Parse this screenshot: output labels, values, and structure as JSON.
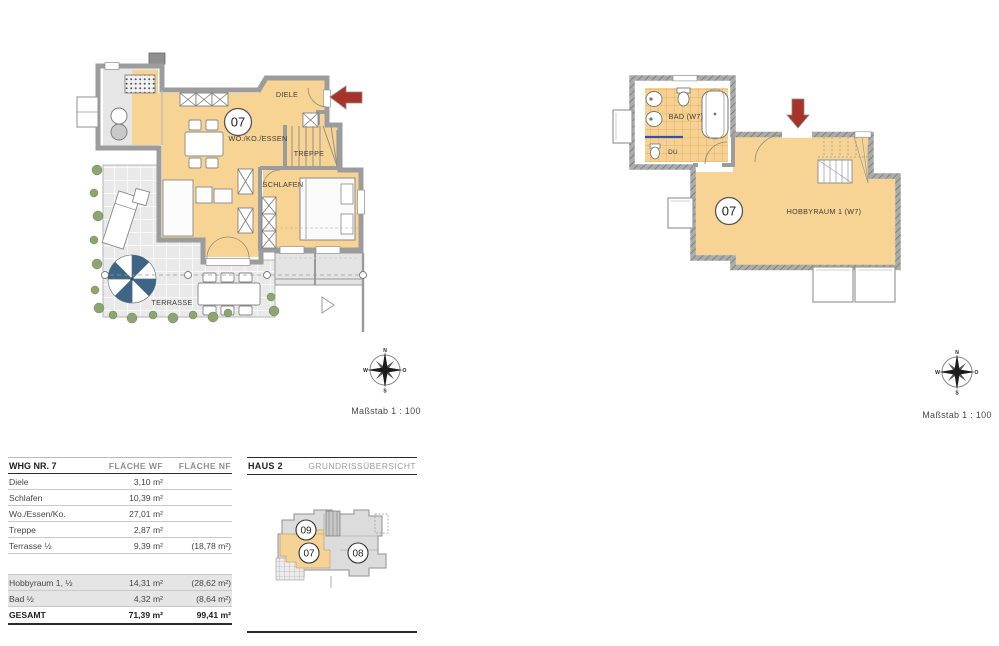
{
  "sheet": {
    "scale_left": "Maßstab 1 : 100",
    "scale_right": "Maßstab 1 : 100"
  },
  "compass": {
    "n": "N",
    "e": "O",
    "s": "S",
    "w": "W"
  },
  "plan_ground": {
    "unit": "07",
    "labels": {
      "diele": "DIELE",
      "wohnen": "WO./KO./ESSEN",
      "treppe": "TREPPE",
      "schlafen": "SCHLAFEN",
      "terrasse": "TERRASSE"
    }
  },
  "plan_basement": {
    "unit": "07",
    "labels": {
      "bad": "BAD (W7)",
      "dusche": "DU",
      "hobbyraum": "HOBBYRAUM 1 (W7)"
    }
  },
  "area_table": {
    "columns": {
      "c1": "WHG NR. 7",
      "c2": "FLÄCHE WF",
      "c3": "FLÄCHE NF"
    },
    "rows": [
      {
        "label": "Diele",
        "wf": "3,10 m²",
        "nf": ""
      },
      {
        "label": "Schlafen",
        "wf": "10,39 m²",
        "nf": ""
      },
      {
        "label": "Wo./Essen/Ko.",
        "wf": "27,01 m²",
        "nf": ""
      },
      {
        "label": "Treppe",
        "wf": "2,87 m²",
        "nf": ""
      },
      {
        "label": "Terrasse ½",
        "wf": "9,39 m²",
        "nf": "(18,78 m²)"
      },
      {
        "label": "Hobbyraum 1, ½",
        "wf": "14,31 m²",
        "nf": "(28,62 m²)"
      },
      {
        "label": "Bad ½",
        "wf": "4,32 m²",
        "nf": "(8,64 m²)"
      }
    ],
    "total": {
      "label": "GESAMT",
      "wf": "71,39 m²",
      "nf": "99,41 m²"
    }
  },
  "overview": {
    "title": "HAUS 2",
    "subtitle": "GRUNDRISSÜBERSICHT",
    "unit_top": "09",
    "unit_left": "07",
    "unit_right": "08"
  },
  "colors": {
    "room_fill": "#f8d494",
    "wall_gray": "#9c9c9c",
    "arrow_red": "#a8332a",
    "umbrella_blue": "#3d6585",
    "greenery": "#8da572",
    "shaded_row": "#e5e5e5"
  }
}
